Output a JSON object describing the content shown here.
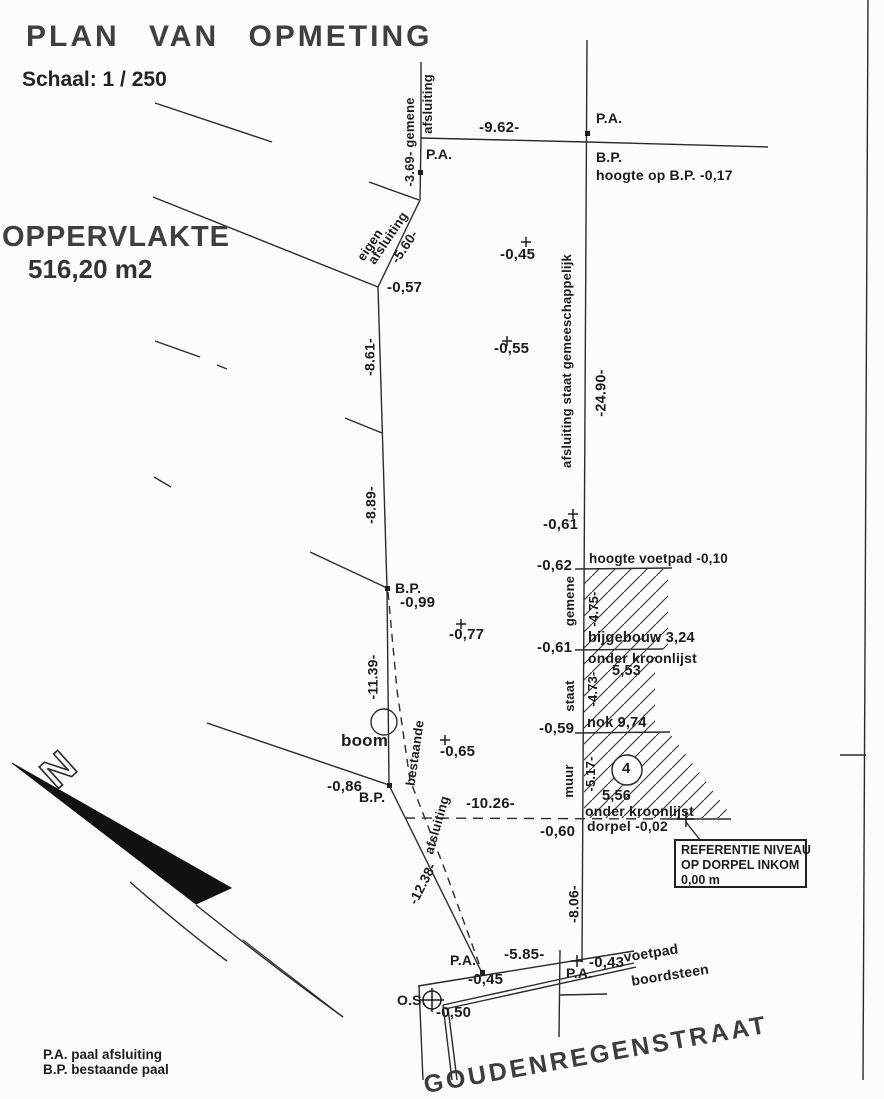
{
  "header": {
    "title": "PLAN VAN OPMETING",
    "scale": "Schaal: 1 / 250",
    "area_label": "OPPERVLAKTE",
    "area_value": "516,20 m2"
  },
  "compass": {
    "n": "N"
  },
  "reference_box": {
    "line1": "REFERENTIE NIVEAU",
    "line2": "OP DORPEL INKOM",
    "line3": "0,00 m"
  },
  "legend": {
    "line1": "P.A. paal afsluiting",
    "line2": "B.P. bestaande paal"
  },
  "labels": [
    {
      "name": "pa-label-top-right",
      "text": "P.A.",
      "x": 596,
      "y": 111,
      "size": 14
    },
    {
      "name": "dim-9-62",
      "text": "-9.62-",
      "x": 479,
      "y": 120,
      "size": 15
    },
    {
      "name": "bp-label-top",
      "text": "B.P.",
      "x": 596,
      "y": 150,
      "size": 14
    },
    {
      "name": "hoogte-op-bp",
      "text": "hoogte op B.P. -0,17",
      "x": 596,
      "y": 168,
      "size": 14
    },
    {
      "name": "pa-label-top-left",
      "text": "P.A.",
      "x": 426,
      "y": 147,
      "size": 14
    },
    {
      "name": "level-045-top",
      "text": "-0,45",
      "x": 500,
      "y": 247,
      "size": 15
    },
    {
      "name": "level-055",
      "text": "-0,55",
      "x": 494,
      "y": 341,
      "size": 15
    },
    {
      "name": "level-061-mid",
      "text": "-0,61",
      "x": 543,
      "y": 517,
      "size": 15
    },
    {
      "name": "level-062",
      "text": "-0,62",
      "x": 537,
      "y": 558,
      "size": 15
    },
    {
      "name": "hoogte-voetpad",
      "text": "hoogte voetpad -0,10",
      "x": 589,
      "y": 552,
      "size": 13.5
    },
    {
      "name": "bijgebouw",
      "text": "bijgebouw 3,24",
      "x": 588,
      "y": 631,
      "size": 14.5
    },
    {
      "name": "level-061-low",
      "text": "-0,61",
      "x": 537,
      "y": 640,
      "size": 15
    },
    {
      "name": "onder-kroonlijst-1",
      "text": "onder kroonlijst",
      "x": 588,
      "y": 651,
      "size": 14
    },
    {
      "name": "value-553",
      "text": "5,53",
      "x": 612,
      "y": 664,
      "size": 14.5
    },
    {
      "name": "nok-974",
      "text": "nok 9,74",
      "x": 587,
      "y": 716,
      "size": 14.5
    },
    {
      "name": "level-059",
      "text": "-0,59",
      "x": 539,
      "y": 721,
      "size": 15
    },
    {
      "name": "value-556",
      "text": "5,56",
      "x": 602,
      "y": 789,
      "size": 14.5
    },
    {
      "name": "onder-kroonlijst-2",
      "text": "onder kroonlijst",
      "x": 585,
      "y": 804,
      "size": 14
    },
    {
      "name": "dorpel",
      "text": "dorpel -0,02",
      "x": 587,
      "y": 819,
      "size": 14
    },
    {
      "name": "level-060",
      "text": "-0,60",
      "x": 540,
      "y": 824,
      "size": 15
    },
    {
      "name": "dim-10-26",
      "text": "-10.26-",
      "x": 466,
      "y": 796,
      "size": 15
    },
    {
      "name": "level-086",
      "text": "-0,86",
      "x": 327,
      "y": 779,
      "size": 15
    },
    {
      "name": "bp-label-low",
      "text": "B.P.",
      "x": 359,
      "y": 790,
      "size": 14
    },
    {
      "name": "bp-label-mid",
      "text": "B.P.",
      "x": 395,
      "y": 581,
      "size": 14
    },
    {
      "name": "level-099",
      "text": "-0,99",
      "x": 400,
      "y": 595,
      "size": 15
    },
    {
      "name": "level-077",
      "text": "-0,77",
      "x": 449,
      "y": 627,
      "size": 15
    },
    {
      "name": "level-065",
      "text": "-0,65",
      "x": 440,
      "y": 744,
      "size": 15
    },
    {
      "name": "boom-label",
      "text": "boom",
      "x": 341,
      "y": 732,
      "size": 17
    },
    {
      "name": "building-number",
      "text": "4",
      "x": 622,
      "y": 761,
      "size": 15
    },
    {
      "name": "level-057",
      "text": "-0,57",
      "x": 387,
      "y": 280,
      "size": 15
    },
    {
      "name": "pa-label-bottom-1",
      "text": "P.A.",
      "x": 450,
      "y": 953,
      "size": 14
    },
    {
      "name": "dim-5-85",
      "text": "-5.85-",
      "x": 504,
      "y": 947,
      "size": 15
    },
    {
      "name": "level-045-bottom",
      "text": "-0,45",
      "x": 468,
      "y": 972,
      "size": 15
    },
    {
      "name": "pa-label-bottom-2",
      "text": "P.A.",
      "x": 566,
      "y": 966,
      "size": 14
    },
    {
      "name": "level-043",
      "text": "-0,43",
      "x": 589,
      "y": 955,
      "size": 15
    },
    {
      "name": "os-label",
      "text": "O.S.",
      "x": 397,
      "y": 993,
      "size": 14
    },
    {
      "name": "level-050",
      "text": "-0,50",
      "x": 436,
      "y": 1005,
      "size": 15
    },
    {
      "name": "afsluiting-top",
      "text": "afsluiting",
      "x": 428,
      "y": 104,
      "rot": -90,
      "size": 13
    },
    {
      "name": "dim-3-69-gemene",
      "text": "-3.69- gemene",
      "x": 410,
      "y": 142,
      "rot": -90,
      "size": 13
    },
    {
      "name": "eigen",
      "text": "eigen",
      "x": 370,
      "y": 245,
      "rot": -56,
      "size": 13
    },
    {
      "name": "afsluiting-eigen",
      "text": "afsluiting",
      "x": 388,
      "y": 238,
      "rot": -56,
      "size": 13
    },
    {
      "name": "dim-5-60",
      "text": "-5.60-",
      "x": 405,
      "y": 247,
      "rot": -56,
      "size": 13.5
    },
    {
      "name": "dim-8-61",
      "text": "-8.61-",
      "x": 370,
      "y": 357,
      "rot": -90,
      "size": 14
    },
    {
      "name": "dim-8-89",
      "text": "-8.89-",
      "x": 371,
      "y": 505,
      "rot": -90,
      "size": 14
    },
    {
      "name": "afsluiting-gemeeschappelijk",
      "text": "afsluiting staat gemeeschappelijk",
      "x": 567,
      "y": 361,
      "rot": -90,
      "size": 13
    },
    {
      "name": "dim-24-90",
      "text": "-24.90-",
      "x": 602,
      "y": 393,
      "rot": -90,
      "size": 14.5
    },
    {
      "name": "dim-11-39",
      "text": "-11.39-",
      "x": 373,
      "y": 677,
      "rot": -90,
      "size": 14
    },
    {
      "name": "bestaande",
      "text": "bestaande",
      "x": 415,
      "y": 753,
      "rot": -82,
      "size": 13
    },
    {
      "name": "afsluiting-bestaande",
      "text": "afsluiting",
      "x": 437,
      "y": 825,
      "rot": -74,
      "size": 13
    },
    {
      "name": "dim-12-38",
      "text": "-12.38-",
      "x": 423,
      "y": 884,
      "rot": -63,
      "size": 13.5
    },
    {
      "name": "gemene-wall",
      "text": "gemene",
      "x": 570,
      "y": 601,
      "rot": -90,
      "size": 13
    },
    {
      "name": "dim-4-75",
      "text": "-4.75-",
      "x": 594,
      "y": 609,
      "rot": -90,
      "size": 13
    },
    {
      "name": "staat-wall",
      "text": "staat",
      "x": 570,
      "y": 696,
      "rot": -90,
      "size": 13
    },
    {
      "name": "dim-4-73",
      "text": "-4.73-",
      "x": 593,
      "y": 689,
      "rot": -90,
      "size": 13
    },
    {
      "name": "muur-wall",
      "text": "muur",
      "x": 569,
      "y": 781,
      "rot": -90,
      "size": 13
    },
    {
      "name": "dim-5-17",
      "text": "-5.17-",
      "x": 591,
      "y": 774,
      "rot": -90,
      "size": 13
    },
    {
      "name": "dim-8-06",
      "text": "-8.06-",
      "x": 574,
      "y": 904,
      "rot": -90,
      "size": 14
    },
    {
      "name": "voetpad",
      "text": "voetpad",
      "x": 651,
      "y": 953,
      "rot": -9,
      "size": 14
    },
    {
      "name": "boordsteen",
      "text": "boordsteen",
      "x": 670,
      "y": 975,
      "rot": -9,
      "size": 14
    },
    {
      "name": "street-name",
      "text": "GOUDENREGENSTRAAT",
      "x": 596,
      "y": 1055,
      "rot": -10,
      "size": 25,
      "cls": "street"
    }
  ]
}
